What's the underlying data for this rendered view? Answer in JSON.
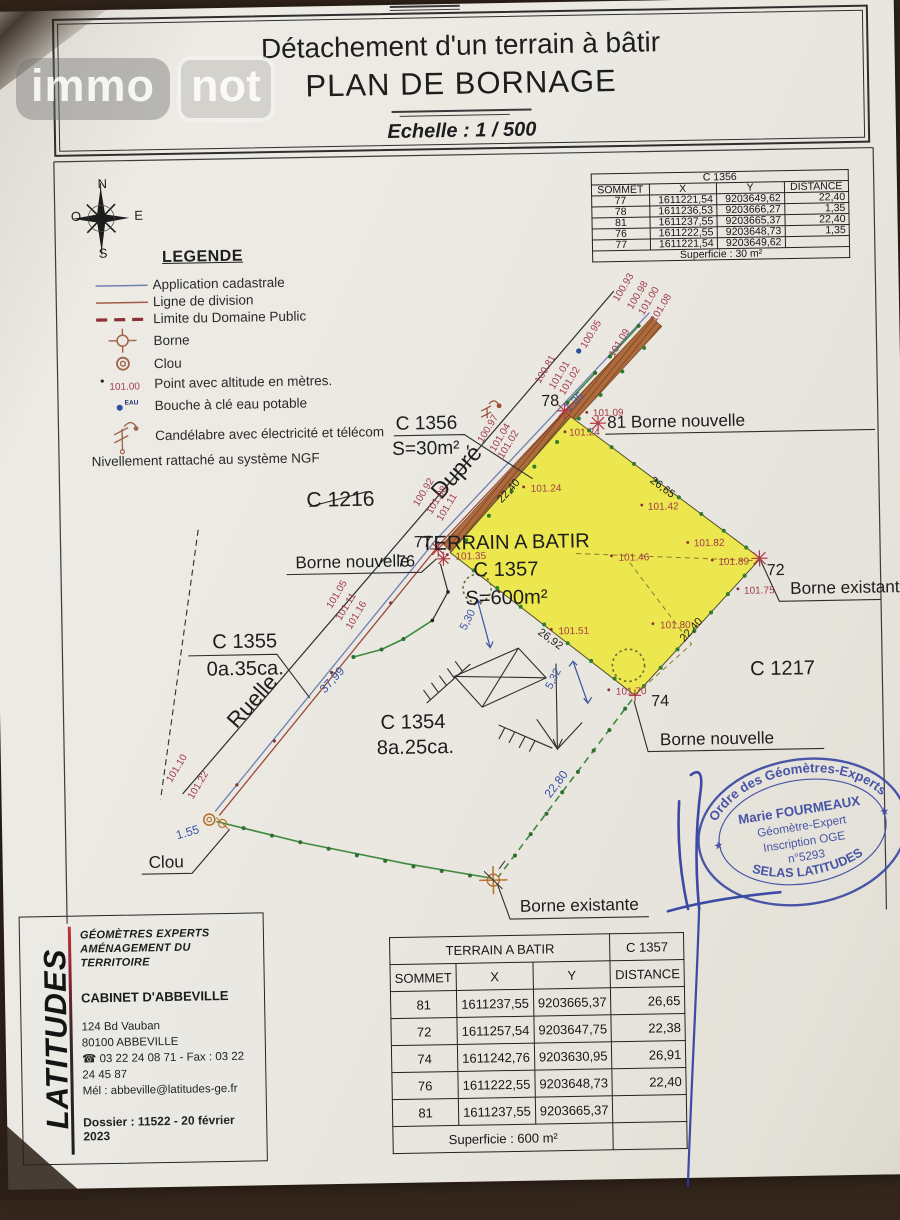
{
  "logo": {
    "immo": "immo",
    "not": "not"
  },
  "title": {
    "line1": "Détachement d'un terrain à bâtir",
    "line2": "PLAN DE BORNAGE",
    "scale": "Echelle : 1 / 500"
  },
  "table_c1356": {
    "layout": "single",
    "title": "C 1356",
    "headers": [
      "SOMMET",
      "X",
      "Y",
      "DISTANCE"
    ],
    "rows": [
      [
        "77",
        "1611221,54",
        "9203649,62",
        "22,40"
      ],
      [
        "78",
        "1611236,53",
        "9203666,27",
        "1,35"
      ],
      [
        "81",
        "1611237,55",
        "9203665,37",
        "22,40"
      ],
      [
        "76",
        "1611222,55",
        "9203648,73",
        "1,35"
      ],
      [
        "77",
        "1611221,54",
        "9203649,62",
        ""
      ]
    ],
    "footer": "Superficie : 30 m²"
  },
  "table_c1357": {
    "layout": "split",
    "title_left": "TERRAIN A BATIR",
    "title_right": "C 1357",
    "headers": [
      "SOMMET",
      "X",
      "Y",
      "DISTANCE"
    ],
    "rows": [
      [
        "81",
        "1611237,55",
        "9203665,37",
        "26,65"
      ],
      [
        "72",
        "1611257,54",
        "9203647,75",
        "22,38"
      ],
      [
        "74",
        "1611242,76",
        "9203630,95",
        "26,91"
      ],
      [
        "76",
        "1611222,55",
        "9203648,73",
        "22,40"
      ],
      [
        "81",
        "1611237,55",
        "9203665,37",
        ""
      ]
    ],
    "footer": "Superficie : 600 m²"
  },
  "legend": {
    "title": "LEGENDE",
    "sample_altitude": "101.00",
    "eau_label": "EAU",
    "items": [
      {
        "label": "Application cadastrale"
      },
      {
        "label": "Ligne de division"
      },
      {
        "label": "Limite du Domaine Public"
      },
      {
        "label": "Borne"
      },
      {
        "label": "Clou"
      },
      {
        "label": "Point avec altitude en mètres."
      },
      {
        "label": "Bouche à clé eau potable"
      },
      {
        "label": "Candélabre avec électricité et télécom"
      }
    ],
    "note": "Nivellement rattaché au système NGF"
  },
  "stamp": {
    "arc_top": "Ordre des Géomètres-Experts",
    "name": "Marie FOURMEAUX",
    "line1": "Géomètre-Expert",
    "line2": "Inscription OGE",
    "line3": "n°5293",
    "arc_bottom": "SELAS LATITUDES",
    "star": "★"
  },
  "cartouche": {
    "brand": "LATITUDES",
    "h1": "GÉOMÈTRES EXPERTS",
    "h2": "AMÉNAGEMENT DU TERRITOIRE",
    "cabinet": "CABINET D'ABBEVILLE",
    "addr1": "124 Bd Vauban",
    "addr2": "80100 ABBEVILLE",
    "phone": "☎ 03 22 24 08 71 - Fax : 03 22 24 45 87",
    "mail": "Mél : abbeville@latitudes-ge.fr",
    "dossier": "Dossier : 11522 - 20 février 2023"
  },
  "colors": {
    "k": "#1d1d1d",
    "r": "#a23b4b",
    "b": "#3d55a5"
  },
  "plan": {
    "texts": [
      {
        "t": "N",
        "x": 106,
        "y": 177,
        "s": 13
      },
      {
        "t": "O",
        "x": 79,
        "y": 209,
        "s": 13
      },
      {
        "t": "E",
        "x": 142,
        "y": 209,
        "s": 13
      },
      {
        "t": "S",
        "x": 106,
        "y": 246,
        "s": 13
      },
      {
        "t": "C 1216",
        "x": 308,
        "y": 497,
        "s": 21
      },
      {
        "t": "C 1356",
        "x": 398,
        "y": 422,
        "s": 19
      },
      {
        "t": "S=30m²",
        "x": 394,
        "y": 447,
        "s": 19
      },
      {
        "t": "Dupré",
        "x": 463,
        "y": 470,
        "s": 23,
        "r": -47,
        "a": "middle"
      },
      {
        "t": "Ruelle",
        "x": 256,
        "y": 694,
        "s": 22,
        "r": -47,
        "a": "middle"
      },
      {
        "t": "C 1355",
        "x": 212,
        "y": 636,
        "s": 20
      },
      {
        "t": "0a.35ca.",
        "x": 206,
        "y": 663,
        "s": 20
      },
      {
        "t": "C 1354",
        "x": 410,
        "y": 719,
        "s": 20,
        "a": "middle"
      },
      {
        "t": "8a.25ca.",
        "x": 412,
        "y": 744,
        "s": 20,
        "a": "middle"
      },
      {
        "t": "C 1217",
        "x": 778,
        "y": 672,
        "s": 20,
        "a": "middle"
      },
      {
        "t": "TERRAIN A BATIR",
        "x": 505,
        "y": 542,
        "s": 20,
        "a": "middle"
      },
      {
        "t": "C 1357",
        "x": 505,
        "y": 569,
        "s": 20,
        "a": "middle"
      },
      {
        "t": "S=600m²",
        "x": 505,
        "y": 597,
        "s": 20,
        "a": "middle"
      },
      {
        "t": "78",
        "x": 543,
        "y": 401,
        "s": 16
      },
      {
        "t": "81 Borne nouvelle",
        "x": 608,
        "y": 424,
        "s": 17
      },
      {
        "t": "77",
        "x": 414,
        "y": 539,
        "s": 16
      },
      {
        "t": "76",
        "x": 397,
        "y": 558,
        "s": 16
      },
      {
        "t": "72",
        "x": 764,
        "y": 573,
        "s": 16
      },
      {
        "t": "74",
        "x": 647,
        "y": 701,
        "s": 16
      },
      {
        "t": "Borne nouvelle",
        "x": 296,
        "y": 558,
        "s": 17
      },
      {
        "t": "Borne existante",
        "x": 787,
        "y": 592,
        "s": 17
      },
      {
        "t": "Borne nouvelle",
        "x": 655,
        "y": 740,
        "s": 17
      },
      {
        "t": "Borne existante",
        "x": 513,
        "y": 903,
        "s": 17
      },
      {
        "t": "Clou",
        "x": 145,
        "y": 853,
        "s": 17
      },
      {
        "t": "37,99",
        "x": 323,
        "y": 683,
        "s": 12,
        "r": -47,
        "c": "b"
      },
      {
        "t": "22,80",
        "x": 545,
        "y": 791,
        "s": 12,
        "r": -52,
        "c": "b"
      },
      {
        "t": "5,30",
        "x": 464,
        "y": 623,
        "s": 11,
        "r": -62,
        "c": "b"
      },
      {
        "t": "5,32",
        "x": 548,
        "y": 683,
        "s": 11,
        "r": -62,
        "c": "b"
      },
      {
        "t": "1,35",
        "x": 570,
        "y": 407,
        "s": 11,
        "r": -42,
        "c": "b"
      },
      {
        "t": "1.55",
        "x": 174,
        "y": 825,
        "s": 12,
        "r": -15,
        "c": "b"
      },
      {
        "t": "22,40",
        "x": 502,
        "y": 497,
        "s": 11,
        "r": -47
      },
      {
        "t": "26,65",
        "x": 649,
        "y": 478,
        "s": 11,
        "r": 38
      },
      {
        "t": "26,92",
        "x": 535,
        "y": 627,
        "s": 11,
        "r": 37
      },
      {
        "t": "22,40",
        "x": 681,
        "y": 638,
        "s": 11,
        "r": -47
      },
      {
        "t": "100.93",
        "x": 621,
        "y": 299,
        "s": 10,
        "r": -58,
        "c": "r"
      },
      {
        "t": "100.98",
        "x": 635,
        "y": 307,
        "s": 10,
        "r": -58,
        "c": "r"
      },
      {
        "t": "101.00",
        "x": 646,
        "y": 313,
        "s": 10,
        "r": -58,
        "c": "r"
      },
      {
        "t": "101.08",
        "x": 658,
        "y": 320,
        "s": 10,
        "r": -58,
        "c": "r"
      },
      {
        "t": "100.95",
        "x": 588,
        "y": 345,
        "s": 10,
        "r": -58,
        "c": "r"
      },
      {
        "t": "101.09",
        "x": 616,
        "y": 354,
        "s": 10,
        "r": -58,
        "c": "r"
      },
      {
        "t": "100.81",
        "x": 542,
        "y": 379,
        "s": 10,
        "r": -58,
        "c": "r"
      },
      {
        "t": "101.01",
        "x": 556,
        "y": 385,
        "s": 10,
        "r": -58,
        "c": "r"
      },
      {
        "t": "101.02",
        "x": 566,
        "y": 391,
        "s": 10,
        "r": -58,
        "c": "r"
      },
      {
        "t": "100.97",
        "x": 484,
        "y": 437,
        "s": 10,
        "r": -58,
        "c": "r"
      },
      {
        "t": "101.04",
        "x": 496,
        "y": 446,
        "s": 10,
        "r": -58,
        "c": "r"
      },
      {
        "t": "101.02",
        "x": 504,
        "y": 453,
        "s": 10,
        "r": -58,
        "c": "r"
      },
      {
        "t": "100.92",
        "x": 419,
        "y": 499,
        "s": 10,
        "r": -58,
        "c": "r"
      },
      {
        "t": "101.08",
        "x": 432,
        "y": 507,
        "s": 10,
        "r": -58,
        "c": "r"
      },
      {
        "t": "101.11",
        "x": 442,
        "y": 514,
        "s": 10,
        "r": -58,
        "c": "r"
      },
      {
        "t": "101.05",
        "x": 331,
        "y": 599,
        "s": 10,
        "r": -58,
        "c": "r"
      },
      {
        "t": "101.11",
        "x": 340,
        "y": 611,
        "s": 10,
        "r": -58,
        "c": "r"
      },
      {
        "t": "101.16",
        "x": 350,
        "y": 620,
        "s": 10,
        "r": -58,
        "c": "r"
      },
      {
        "t": "101.10",
        "x": 169,
        "y": 769,
        "s": 10,
        "r": -58,
        "c": "r"
      },
      {
        "t": "101.22",
        "x": 190,
        "y": 786,
        "s": 10,
        "r": -58,
        "c": "r"
      },
      {
        "t": "101.09",
        "x": 594,
        "y": 412,
        "s": 10,
        "c": "r"
      },
      {
        "t": "101.24",
        "x": 570,
        "y": 431,
        "s": 10,
        "c": "r"
      },
      {
        "t": "101.24",
        "x": 531,
        "y": 486,
        "s": 10,
        "c": "r"
      },
      {
        "t": "101.35",
        "x": 455,
        "y": 552,
        "s": 10,
        "c": "r"
      },
      {
        "t": "101.42",
        "x": 647,
        "y": 506,
        "s": 10,
        "c": "r"
      },
      {
        "t": "101.46",
        "x": 617,
        "y": 556,
        "s": 10,
        "c": "r"
      },
      {
        "t": "101.82",
        "x": 692,
        "y": 543,
        "s": 10,
        "c": "r"
      },
      {
        "t": "101.89",
        "x": 716,
        "y": 562,
        "s": 10,
        "c": "r"
      },
      {
        "t": "101.75",
        "x": 741,
        "y": 591,
        "s": 10,
        "c": "r"
      },
      {
        "t": "101.51",
        "x": 556,
        "y": 628,
        "s": 10,
        "c": "r"
      },
      {
        "t": "101.80",
        "x": 657,
        "y": 624,
        "s": 10,
        "c": "r"
      },
      {
        "t": "101.70",
        "x": 612,
        "y": 689,
        "s": 10,
        "c": "r"
      }
    ]
  }
}
